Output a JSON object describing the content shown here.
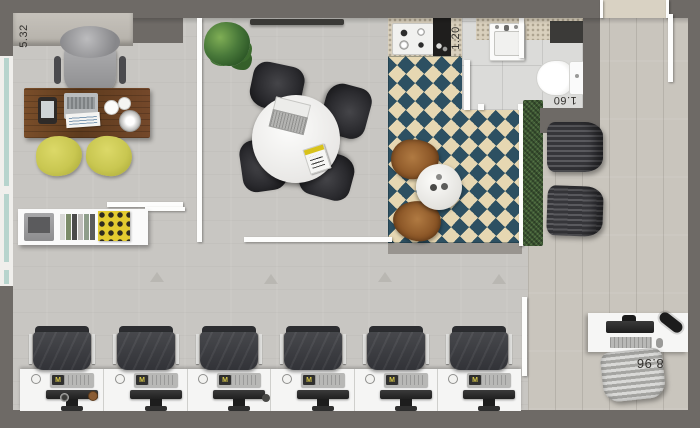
{
  "plan": {
    "dimension_labels": {
      "office": "5.32",
      "kitchen": "1.20",
      "bathroom": "1.60",
      "open_space": "8.96"
    },
    "workstations": {
      "count": 6,
      "keyboard_logo": "M"
    },
    "colors": {
      "wall_gray": "#6e6a66",
      "floor_concrete": "#c8c6c2",
      "floor_wood": "#c9c5bd",
      "rug_navy": "#2d5062",
      "rug_cream": "#e6d7b2",
      "hedge_green": "#3f5a36",
      "desk_wood": "#6f4727",
      "guest_chair_yellow": "#cfcc52",
      "partition_white": "#ffffff",
      "leather_black": "#1c1c1e",
      "counter_granite": "#d9d0bd"
    }
  }
}
